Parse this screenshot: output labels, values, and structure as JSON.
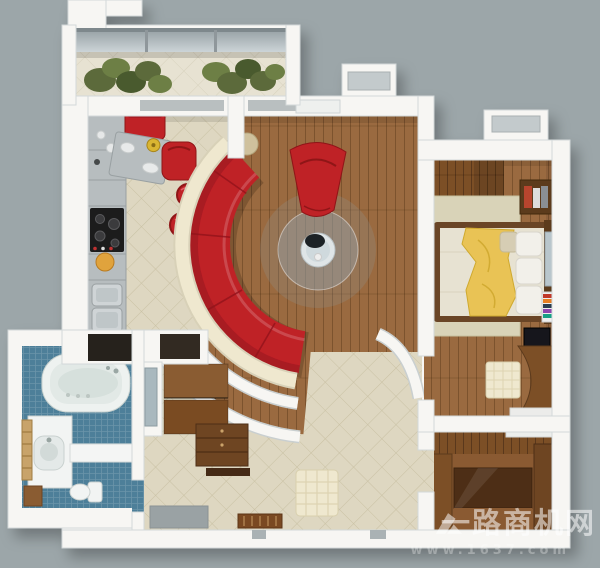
{
  "watermark": {
    "site_name": "一路商机网",
    "url": "www.1637.com",
    "logo_icon": "chevron-arrow-logo"
  },
  "colors": {
    "background": "#9ca6a9",
    "wall": "#f7f6f3",
    "wall-edge": "#d3d8d9",
    "wood": "#9a6a3f",
    "wood-dark": "#7c4f28",
    "wood-deep": "#54351a",
    "tile": "#ded7c1",
    "tile-line": "#c9c1a4",
    "bath-tile": "#4e7f99",
    "sofa-red": "#bf2028",
    "red-dark": "#8f1218",
    "blanket-yellow": "#e9c354",
    "cream": "#efe8cf",
    "rug-beige": "#d9d3b8",
    "counter-gray": "#b7bdbf",
    "glass": "#b9c3c7",
    "plant-green": "#5c6b3a",
    "appliance-dark": "#1d1d1f",
    "watermark": "rgba(255,255,255,0.55)",
    "watermark-faint": "rgba(255,255,255,0.30)"
  }
}
